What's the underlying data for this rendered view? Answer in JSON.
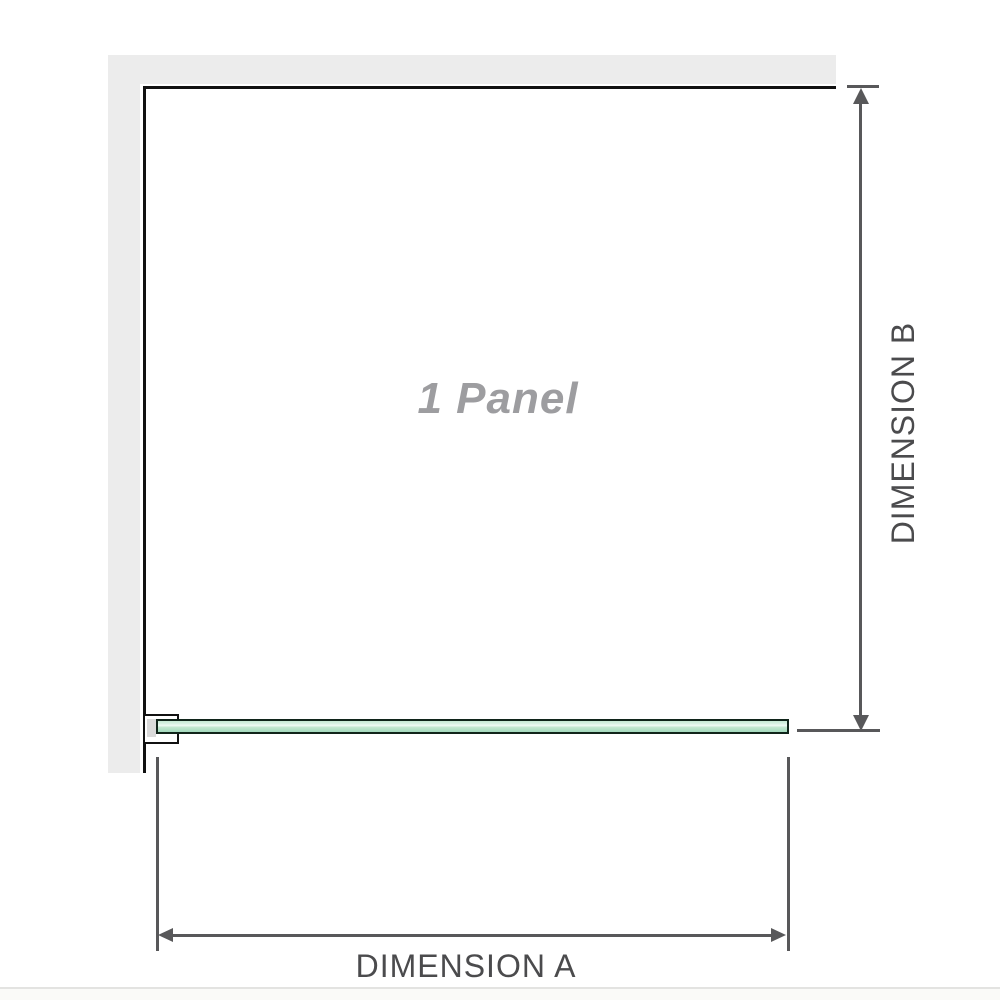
{
  "diagram": {
    "title": "Shower panel dimension diagram",
    "panel_label": "1 Panel",
    "dimension_a_label": "DIMENSION A",
    "dimension_b_label": "DIMENSION B"
  },
  "colors": {
    "background": "#ffffff",
    "wall_fill": "#ececec",
    "panel_outline": "#111111",
    "dimension_line": "#58585a",
    "dimension_text": "#4b4b4d",
    "panel_text": "#9d9da0",
    "glass_border": "#10241a",
    "glass_fill_top": "#c6e9d4",
    "glass_highlight": "#f2fbf6",
    "glass_fill_bottom": "#a3d9bd",
    "bracket_fill": "#ffffff",
    "bracket_shim": "#dadada",
    "bottom_divider": "#e3e3e1"
  }
}
